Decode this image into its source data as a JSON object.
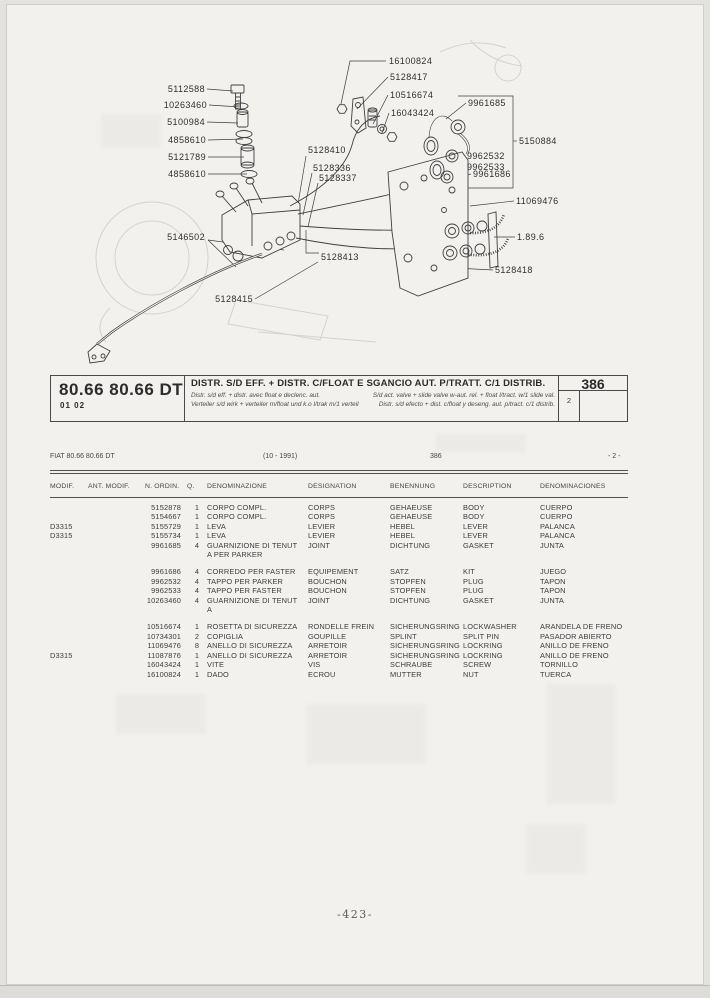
{
  "header": {
    "model": "80.66 80.66 DT",
    "code": "01 02",
    "title": "DISTR. S/D EFF. + DISTR. C/FLOAT E SGANCIO AUT. P/TRATT. C/1 DISTRIB.",
    "subtitle_lines": [
      {
        "left": "Distr. s/d eff. + distr. avec float e declenc. aut.",
        "right": "S/d act. valve + slide valve w-aut. rel. + float l/tract. w/1 slide val."
      },
      {
        "left": "Verteiler s/d wirk + verteiler m/float und k.o l/trak m/1 verteil",
        "right": "Distr. s/d efecto + dist. c/float y deseng. aut. p/tract. c/1 distrib."
      }
    ],
    "page_ref": "386",
    "sheet": "2"
  },
  "meta": {
    "model_line": "FIAT 80.66 80.66 DT",
    "date_range": "(10 - 1991)",
    "page_ref": "386",
    "sheet_ref": "- 2 -"
  },
  "diagram": {
    "labels": [
      {
        "text": "5112588",
        "x": 205,
        "y": 89,
        "anchor": "r"
      },
      {
        "text": "10263460",
        "x": 207,
        "y": 105,
        "anchor": "r"
      },
      {
        "text": "5100984",
        "x": 205,
        "y": 122,
        "anchor": "r"
      },
      {
        "text": "4858610",
        "x": 206,
        "y": 140,
        "anchor": "r"
      },
      {
        "text": "5121789",
        "x": 206,
        "y": 157,
        "anchor": "r"
      },
      {
        "text": "4858610",
        "x": 206,
        "y": 174,
        "anchor": "r"
      },
      {
        "text": "5146502",
        "x": 205,
        "y": 237,
        "anchor": "r"
      },
      {
        "text": "5128415",
        "x": 253,
        "y": 299,
        "anchor": "r"
      },
      {
        "text": "5128410",
        "x": 308,
        "y": 150,
        "anchor": "l"
      },
      {
        "text": "5128336",
        "x": 313,
        "y": 168,
        "anchor": "l"
      },
      {
        "text": "5128337",
        "x": 319,
        "y": 178,
        "anchor": "l"
      },
      {
        "text": "5128413",
        "x": 321,
        "y": 257,
        "anchor": "l"
      },
      {
        "text": "16100824",
        "x": 389,
        "y": 61,
        "anchor": "l"
      },
      {
        "text": "5128417",
        "x": 390,
        "y": 77,
        "anchor": "l"
      },
      {
        "text": "10516674",
        "x": 390,
        "y": 95,
        "anchor": "l"
      },
      {
        "text": "16043424",
        "x": 391,
        "y": 113,
        "anchor": "l"
      },
      {
        "text": "9961685",
        "x": 468,
        "y": 103,
        "anchor": "l"
      },
      {
        "text": "5150884",
        "x": 519,
        "y": 141,
        "anchor": "l"
      },
      {
        "text": "9962532",
        "x": 467,
        "y": 156,
        "anchor": "l"
      },
      {
        "text": "9962533",
        "x": 467,
        "y": 167,
        "anchor": "l"
      },
      {
        "text": "9961686",
        "x": 473,
        "y": 174,
        "anchor": "l"
      },
      {
        "text": "11069476",
        "x": 516,
        "y": 201,
        "anchor": "l"
      },
      {
        "text": "1.89.6",
        "x": 517,
        "y": 237,
        "anchor": "l"
      },
      {
        "text": "5128418",
        "x": 495,
        "y": 270,
        "anchor": "l"
      }
    ]
  },
  "table": {
    "columns": [
      "MODIF.",
      "ANT. MODIF.",
      "N. ORDIN.",
      "Q.",
      "DENOMINAZIONE",
      "DESIGNATION",
      "BENENNUNG",
      "DESCRIPTION",
      "DENOMINACIONES"
    ],
    "groups": [
      [
        {
          "modif": "",
          "ant": "",
          "ord": "5152878",
          "q": "1",
          "den": [
            "CORPO COMPL."
          ],
          "des": "CORPS",
          "ben": "GEHAEUSE",
          "desc": "BODY",
          "denom": "CUERPO"
        },
        {
          "modif": "",
          "ant": "",
          "ord": "5154667",
          "q": "1",
          "den": [
            "CORPO COMPL."
          ],
          "des": "CORPS",
          "ben": "GEHAEUSE",
          "desc": "BODY",
          "denom": "CUERPO"
        },
        {
          "modif": "D3315",
          "ant": "",
          "ord": "5155729",
          "q": "1",
          "den": [
            "LEVA"
          ],
          "des": "LEVIER",
          "ben": "HEBEL",
          "desc": "LEVER",
          "denom": "PALANCA"
        },
        {
          "modif": "D3315",
          "ant": "",
          "ord": "5155734",
          "q": "1",
          "den": [
            "LEVA"
          ],
          "des": "LEVIER",
          "ben": "HEBEL",
          "desc": "LEVER",
          "denom": "PALANCA"
        },
        {
          "modif": "",
          "ant": "",
          "ord": "9961685",
          "q": "4",
          "den": [
            "GUARNIZIONE DI TENUT",
            "A PER PARKER"
          ],
          "des": "JOINT",
          "ben": "DICHTUNG",
          "desc": "GASKET",
          "denom": "JUNTA"
        }
      ],
      [
        {
          "modif": "",
          "ant": "",
          "ord": "9961686",
          "q": "4",
          "den": [
            "CORREDO PER FASTER"
          ],
          "des": "EQUIPEMENT",
          "ben": "SATZ",
          "desc": "KIT",
          "denom": "JUEGO"
        },
        {
          "modif": "",
          "ant": "",
          "ord": "9962532",
          "q": "4",
          "den": [
            "TAPPO PER PARKER"
          ],
          "des": "BOUCHON",
          "ben": "STOPFEN",
          "desc": "PLUG",
          "denom": "TAPON"
        },
        {
          "modif": "",
          "ant": "",
          "ord": "9962533",
          "q": "4",
          "den": [
            "TAPPO PER FASTER"
          ],
          "des": "BOUCHON",
          "ben": "STOPFEN",
          "desc": "PLUG",
          "denom": "TAPON"
        },
        {
          "modif": "",
          "ant": "",
          "ord": "10263460",
          "q": "4",
          "den": [
            "GUARNIZIONE DI TENUT",
            "A"
          ],
          "des": "JOINT",
          "ben": "DICHTUNG",
          "desc": "GASKET",
          "denom": "JUNTA"
        }
      ],
      [
        {
          "modif": "",
          "ant": "",
          "ord": "10516674",
          "q": "1",
          "den": [
            "ROSETTA DI SICUREZZA"
          ],
          "des": "RONDELLE FREIN",
          "ben": "SICHERUNGSRING",
          "desc": "LOCKWASHER",
          "denom": "ARANDELA DE FRENO"
        },
        {
          "modif": "",
          "ant": "",
          "ord": "10734301",
          "q": "2",
          "den": [
            "COPIGLIA"
          ],
          "des": "GOUPILLE",
          "ben": "SPLINT",
          "desc": "SPLIT PIN",
          "denom": "PASADOR ABIERTO"
        },
        {
          "modif": "",
          "ant": "",
          "ord": "11069476",
          "q": "8",
          "den": [
            "ANELLO DI SICUREZZA"
          ],
          "des": "ARRETOIR",
          "ben": "SICHERUNGSRING",
          "desc": "LOCKRING",
          "denom": "ANILLO DE FRENO"
        },
        {
          "modif": "D3315",
          "ant": "",
          "ord": "11087876",
          "q": "1",
          "den": [
            "ANELLO DI SICUREZZA"
          ],
          "des": "ARRETOIR",
          "ben": "SICHERUNGSRING",
          "desc": "LOCKRING",
          "denom": "ANILLO DE FRENO"
        },
        {
          "modif": "",
          "ant": "",
          "ord": "16043424",
          "q": "1",
          "den": [
            "VITE"
          ],
          "des": "VIS",
          "ben": "SCHRAUBE",
          "desc": "SCREW",
          "denom": "TORNILLO"
        },
        {
          "modif": "",
          "ant": "",
          "ord": "16100824",
          "q": "1",
          "den": [
            "DADO"
          ],
          "des": "ECROU",
          "ben": "MUTTER",
          "desc": "NUT",
          "denom": "TUERCA"
        }
      ]
    ]
  },
  "footer": {
    "page_number": "-423-"
  }
}
